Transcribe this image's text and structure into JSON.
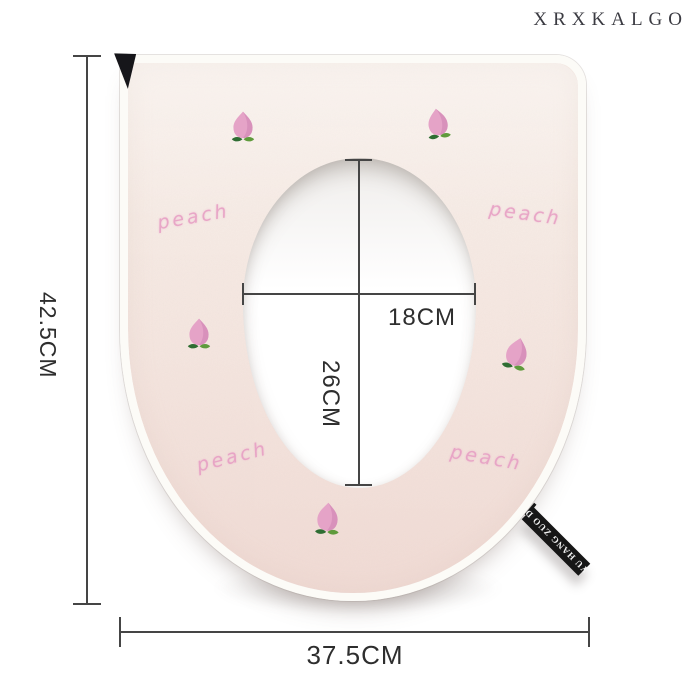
{
  "brand": "XRXKALGO",
  "annotations": {
    "height_label": "42.5CM",
    "width_label": "37.5CM",
    "inner_width_label": "18CM",
    "inner_height_label": "26CM"
  },
  "product": {
    "embroidery_text": "peach",
    "tag_text": "YU HANG ZUO D"
  },
  "colors": {
    "background": "#ffffff",
    "mat_fill_top": "#f8efe9",
    "mat_fill_bottom": "#f2e1db",
    "mat_piping": "#fcfbf7",
    "hole": "#ffffff",
    "peach_body_pink": "#e5a3c7",
    "peach_shade_pink": "#d389b6",
    "peach_leaf_dark_green": "#2f6d33",
    "peach_leaf_light_green": "#5f9a3c",
    "embroidery_text_pink": "#e79fc4",
    "dimension_line": "#454545",
    "label_text": "#2e2e2e",
    "brand_text": "#3b3b42",
    "tag_black": "#161616",
    "tag_text_white": "#f2f2f2"
  }
}
